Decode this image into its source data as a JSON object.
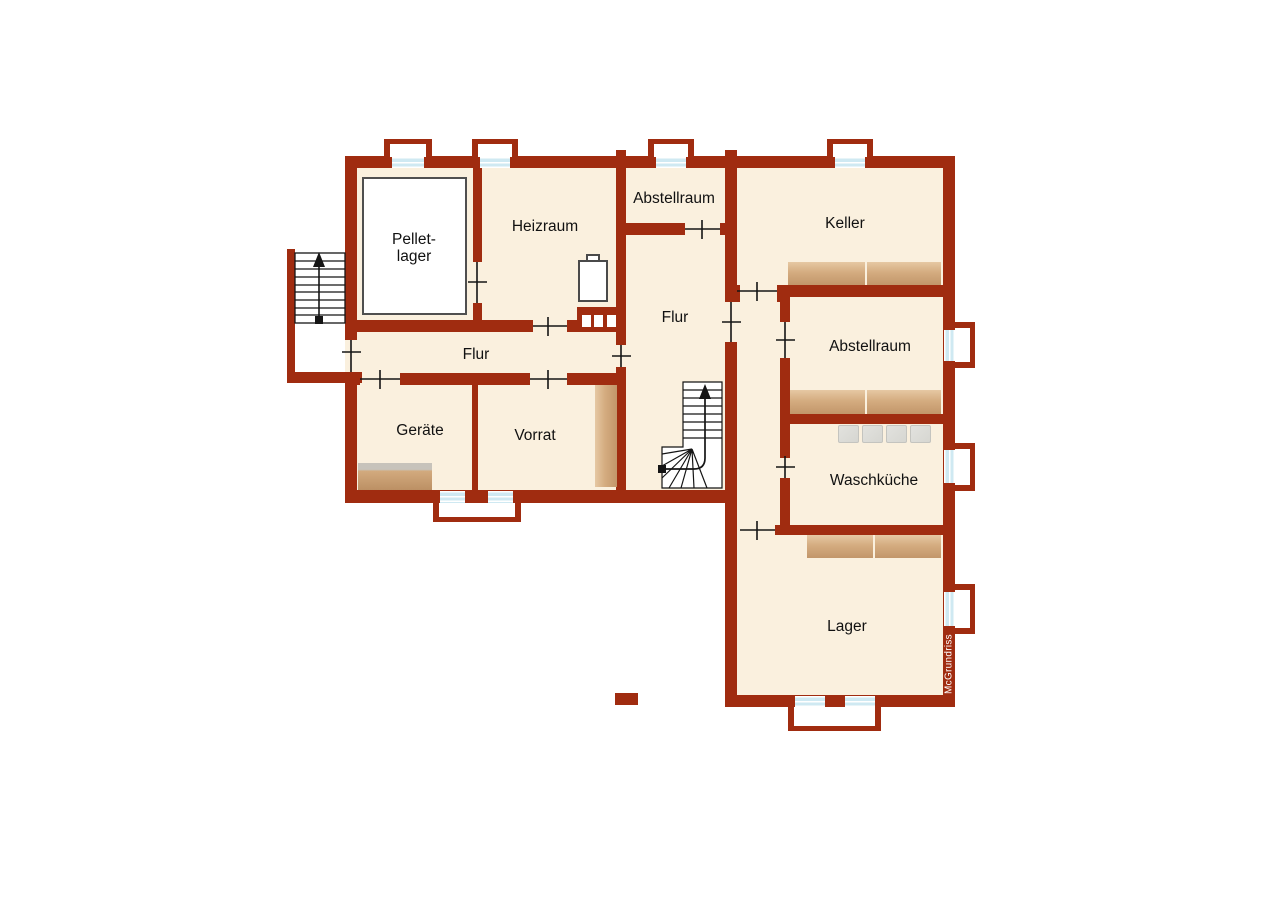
{
  "floorplan": {
    "labels": {
      "pelletlager_line1": "Pellet-",
      "pelletlager_line2": "lager",
      "heizraum": "Heizraum",
      "abstellraum_top": "Abstellraum",
      "keller": "Keller",
      "flur_center": "Flur",
      "abstellraum_right": "Abstellraum",
      "flur_west": "Flur",
      "geraete": "Geräte",
      "vorrat": "Vorrat",
      "waschkueche": "Waschküche",
      "lager": "Lager"
    },
    "watermark": "McGrundriss",
    "colors": {
      "wall": "#A02C10",
      "room_fill": "#FAF0DE",
      "background": "#FFFFFF",
      "shelf_light": "#E6C8A3",
      "shelf_dark": "#C2966A",
      "window_glass": "#CFE9F2",
      "appliance_gray": "#DCDCD7",
      "linework": "#151515",
      "watermark_text": "#FFFFFF"
    }
  }
}
